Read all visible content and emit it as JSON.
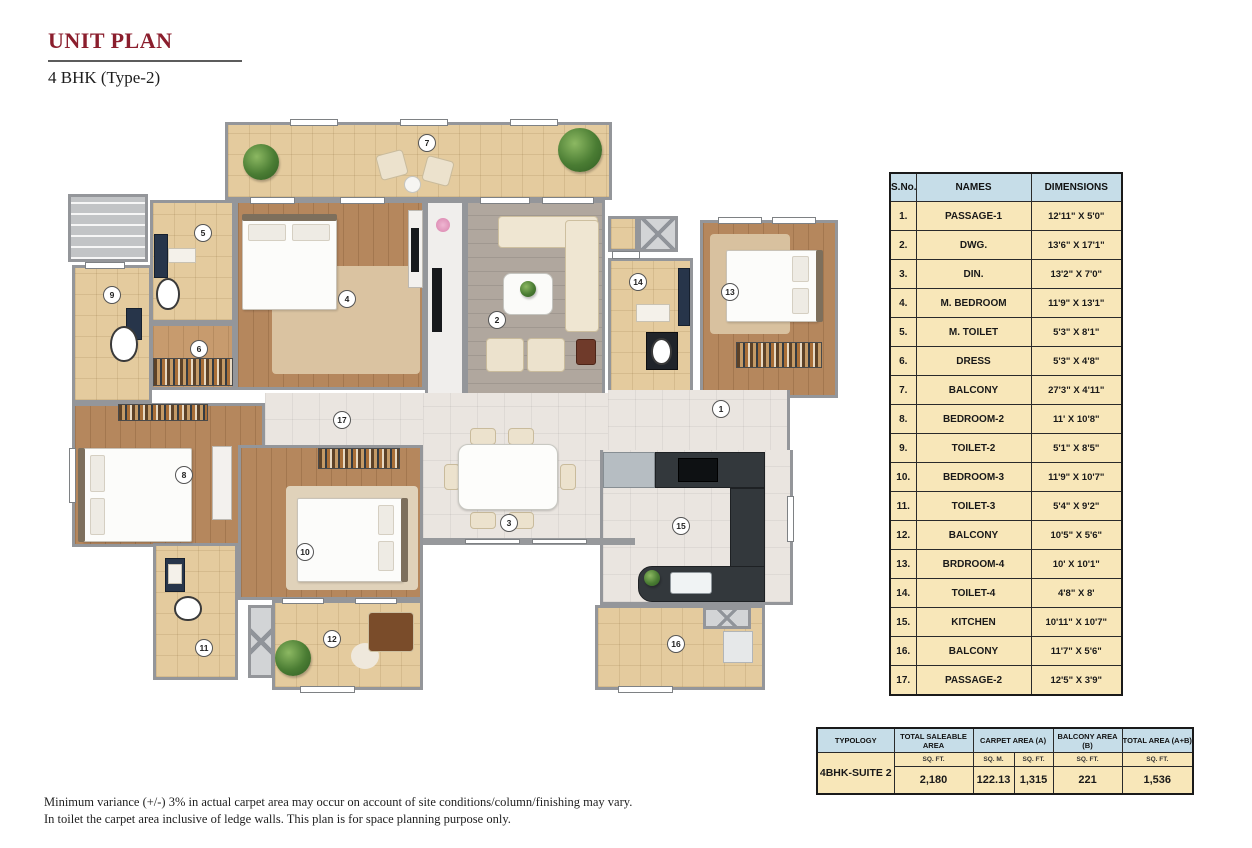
{
  "header": {
    "title": "UNIT PLAN",
    "subtitle": "4 BHK (Type-2)"
  },
  "colors": {
    "accent_maroon": "#8b1e2d",
    "table_header_blue": "#c6dde8",
    "table_body_cream": "#f8e7b9",
    "wall_gray": "#97999c"
  },
  "rooms_table": {
    "headers": [
      "S.No.",
      "NAMES",
      "DIMENSIONS"
    ],
    "rows": [
      {
        "sno": "1.",
        "name": "PASSAGE-1",
        "dim": "12'11\" X 5'0\""
      },
      {
        "sno": "2.",
        "name": "DWG.",
        "dim": "13'6\" X 17'1\""
      },
      {
        "sno": "3.",
        "name": "DIN.",
        "dim": "13'2\" X 7'0\""
      },
      {
        "sno": "4.",
        "name": "M. BEDROOM",
        "dim": "11'9\" X 13'1\""
      },
      {
        "sno": "5.",
        "name": "M. TOILET",
        "dim": "5'3\" X 8'1\""
      },
      {
        "sno": "6.",
        "name": "DRESS",
        "dim": "5'3\" X 4'8\""
      },
      {
        "sno": "7.",
        "name": "BALCONY",
        "dim": "27'3\" X 4'11\""
      },
      {
        "sno": "8.",
        "name": "BEDROOM-2",
        "dim": "11' X 10'8\""
      },
      {
        "sno": "9.",
        "name": "TOILET-2",
        "dim": "5'1\" X 8'5\""
      },
      {
        "sno": "10.",
        "name": "BEDROOM-3",
        "dim": "11'9\" X 10'7\""
      },
      {
        "sno": "11.",
        "name": "TOILET-3",
        "dim": "5'4\" X 9'2\""
      },
      {
        "sno": "12.",
        "name": "BALCONY",
        "dim": "10'5\" X 5'6\""
      },
      {
        "sno": "13.",
        "name": "BRDROOM-4",
        "dim": "10' X 10'1\""
      },
      {
        "sno": "14.",
        "name": "TOILET-4",
        "dim": "4'8\" X 8'"
      },
      {
        "sno": "15.",
        "name": "KITCHEN",
        "dim": "10'11\" X 10'7\""
      },
      {
        "sno": "16.",
        "name": "BALCONY",
        "dim": "11'7\" X 5'6\""
      },
      {
        "sno": "17.",
        "name": "PASSAGE-2",
        "dim": "12'5\" X 3'9\""
      }
    ]
  },
  "area_table": {
    "headers": [
      "TYPOLOGY",
      "TOTAL SALEABLE AREA",
      "CARPET AREA  (A)",
      "BALCONY AREA   (B)",
      "TOTAL AREA  (A+B)"
    ],
    "typology_value": "4BHK-SUITE 2",
    "units": [
      "SQ. FT.",
      "SQ. M.",
      "SQ. FT.",
      "SQ. FT.",
      "SQ. FT."
    ],
    "values": [
      "2,180",
      "122.13",
      "1,315",
      "221",
      "1,536"
    ]
  },
  "footnote": {
    "line1": "Minimum variance (+/-) 3% in actual carpet area may occur on account of site conditions/column/finishing may vary.",
    "line2": "In toilet the carpet area inclusive of ledge walls. This plan is for space planning purpose only."
  },
  "plan": {
    "rooms": [
      {
        "id": "lobby-stairs",
        "fl": "stairs",
        "x": 8,
        "y": 76,
        "w": 80,
        "h": 68,
        "b": "1111"
      },
      {
        "id": "balcony-7",
        "fl": "beige",
        "x": 165,
        "y": 4,
        "w": 387,
        "h": 78,
        "b": "1111"
      },
      {
        "id": "m-toilet-5",
        "fl": "beige",
        "x": 90,
        "y": 82,
        "w": 85,
        "h": 123,
        "b": "1111"
      },
      {
        "id": "toilet-2",
        "fl": "beige",
        "x": 12,
        "y": 147,
        "w": 80,
        "h": 138,
        "b": "1111"
      },
      {
        "id": "m-bedroom-4",
        "fl": "wood",
        "x": 175,
        "y": 82,
        "w": 190,
        "h": 190,
        "b": "1111"
      },
      {
        "id": "tv-niche",
        "fl": "plain",
        "x": 365,
        "y": 82,
        "w": 40,
        "h": 198,
        "b": "1111"
      },
      {
        "id": "dress-6",
        "fl": "woodlight",
        "x": 90,
        "y": 205,
        "w": 85,
        "h": 67,
        "b": "1111"
      },
      {
        "id": "dwg-2",
        "fl": "tilegray",
        "x": 405,
        "y": 82,
        "w": 140,
        "h": 198,
        "b": "1101"
      },
      {
        "id": "shaft-closet",
        "fl": "beige",
        "x": 548,
        "y": 98,
        "w": 30,
        "h": 36,
        "b": "1111"
      },
      {
        "id": "shaft-1",
        "fl": "shaft",
        "x": 578,
        "y": 98,
        "w": 40,
        "h": 36,
        "b": "1111"
      },
      {
        "id": "toilet-4",
        "fl": "beige",
        "x": 548,
        "y": 140,
        "w": 85,
        "h": 140,
        "b": "1111"
      },
      {
        "id": "bedroom-4",
        "fl": "wood",
        "x": 640,
        "y": 102,
        "w": 138,
        "h": 178,
        "b": "1111"
      },
      {
        "id": "passage-2",
        "fl": "tile",
        "x": 205,
        "y": 275,
        "w": 160,
        "h": 54,
        "b": "0000"
      },
      {
        "id": "dining-3",
        "fl": "tile",
        "x": 363,
        "y": 275,
        "w": 205,
        "h": 149,
        "b": "0000"
      },
      {
        "id": "passage-1",
        "fl": "tile",
        "x": 548,
        "y": 272,
        "w": 182,
        "h": 64,
        "b": "0100"
      },
      {
        "id": "bedroom-2",
        "fl": "wood",
        "x": 12,
        "y": 285,
        "w": 193,
        "h": 144,
        "b": "1111"
      },
      {
        "id": "bedroom-3",
        "fl": "wood",
        "x": 178,
        "y": 327,
        "w": 185,
        "h": 155,
        "b": "1111"
      },
      {
        "id": "toilet-3",
        "fl": "beige",
        "x": 93,
        "y": 425,
        "w": 85,
        "h": 137,
        "b": "1111"
      },
      {
        "id": "shaft-3",
        "fl": "shaft",
        "x": 188,
        "y": 487,
        "w": 26,
        "h": 73,
        "b": "1111"
      },
      {
        "id": "balcony-12",
        "fl": "beige",
        "x": 212,
        "y": 482,
        "w": 151,
        "h": 90,
        "b": "1111"
      },
      {
        "id": "kitchen-15",
        "fl": "tile",
        "x": 540,
        "y": 332,
        "w": 193,
        "h": 155,
        "b": "0111"
      },
      {
        "id": "balcony-16",
        "fl": "beige",
        "x": 535,
        "y": 487,
        "w": 170,
        "h": 85,
        "b": "1111"
      },
      {
        "id": "shaft-2",
        "fl": "shaft",
        "x": 643,
        "y": 489,
        "w": 48,
        "h": 22,
        "b": "1111"
      }
    ],
    "walls": [
      {
        "x": 363,
        "y": 420,
        "w": 212,
        "h": 7
      }
    ],
    "windows": [
      {
        "x": 230,
        "y": 1,
        "w": 48,
        "h": 7
      },
      {
        "x": 340,
        "y": 1,
        "w": 48,
        "h": 7
      },
      {
        "x": 450,
        "y": 1,
        "w": 48,
        "h": 7
      },
      {
        "x": 190,
        "y": 79,
        "w": 45,
        "h": 7
      },
      {
        "x": 280,
        "y": 79,
        "w": 45,
        "h": 7
      },
      {
        "x": 420,
        "y": 79,
        "w": 50,
        "h": 7
      },
      {
        "x": 482,
        "y": 79,
        "w": 52,
        "h": 7
      },
      {
        "x": 658,
        "y": 99,
        "w": 44,
        "h": 7
      },
      {
        "x": 712,
        "y": 99,
        "w": 44,
        "h": 7
      },
      {
        "x": 552,
        "y": 133,
        "w": 28,
        "h": 8
      },
      {
        "x": 222,
        "y": 480,
        "w": 42,
        "h": 6
      },
      {
        "x": 295,
        "y": 480,
        "w": 42,
        "h": 6
      },
      {
        "x": 240,
        "y": 568,
        "w": 55,
        "h": 7
      },
      {
        "x": 558,
        "y": 568,
        "w": 55,
        "h": 7
      },
      {
        "x": 9,
        "y": 330,
        "w": 7,
        "h": 55
      },
      {
        "x": 25,
        "y": 144,
        "w": 40,
        "h": 7
      },
      {
        "x": 727,
        "y": 378,
        "w": 7,
        "h": 46
      },
      {
        "x": 405,
        "y": 421,
        "w": 55,
        "h": 5
      },
      {
        "x": 472,
        "y": 421,
        "w": 55,
        "h": 5
      }
    ],
    "furniture": [
      {
        "t": "plant",
        "x": 183,
        "y": 26,
        "w": 36,
        "h": 36
      },
      {
        "t": "plant",
        "x": 498,
        "y": 10,
        "w": 44,
        "h": 44
      },
      {
        "t": "chair",
        "x": 318,
        "y": 34,
        "w": 28,
        "h": 26,
        "r": -15
      },
      {
        "t": "chair",
        "x": 364,
        "y": 40,
        "w": 28,
        "h": 26,
        "r": 15
      },
      {
        "t": "tround",
        "x": 344,
        "y": 58,
        "w": 17,
        "h": 17
      },
      {
        "t": "vanity",
        "x": 94,
        "y": 116,
        "w": 14,
        "h": 44
      },
      {
        "t": "cwhite",
        "x": 108,
        "y": 130,
        "w": 28,
        "h": 15
      },
      {
        "t": "wc",
        "x": 96,
        "y": 160,
        "w": 24,
        "h": 32
      },
      {
        "t": "vanity",
        "x": 66,
        "y": 190,
        "w": 16,
        "h": 32
      },
      {
        "t": "wc",
        "x": 50,
        "y": 208,
        "w": 28,
        "h": 36
      },
      {
        "t": "rug",
        "x": 212,
        "y": 148,
        "w": 148,
        "h": 108,
        "c": "#dac3a1"
      },
      {
        "t": "bed",
        "x": 182,
        "y": 100,
        "w": 95,
        "h": 92
      },
      {
        "t": "hb",
        "x": 182,
        "y": 96,
        "w": 95,
        "h": 7
      },
      {
        "t": "pillow",
        "x": 188,
        "y": 106,
        "w": 38,
        "h": 17
      },
      {
        "t": "pillow",
        "x": 232,
        "y": 106,
        "w": 38,
        "h": 17
      },
      {
        "t": "dresser",
        "x": 348,
        "y": 92,
        "w": 15,
        "h": 78
      },
      {
        "t": "tv",
        "x": 351,
        "y": 110,
        "w": 8,
        "h": 44
      },
      {
        "t": "flower",
        "x": 376,
        "y": 100,
        "w": 14,
        "h": 14
      },
      {
        "t": "tv",
        "x": 372,
        "y": 150,
        "w": 10,
        "h": 64
      },
      {
        "t": "wardrobe",
        "x": 93,
        "y": 240,
        "w": 80,
        "h": 28
      },
      {
        "t": "sofa",
        "x": 438,
        "y": 98,
        "w": 100,
        "h": 32
      },
      {
        "t": "sofa",
        "x": 505,
        "y": 102,
        "w": 34,
        "h": 112
      },
      {
        "t": "ctable",
        "x": 443,
        "y": 155,
        "w": 50,
        "h": 42
      },
      {
        "t": "plant",
        "x": 460,
        "y": 163,
        "w": 16,
        "h": 16
      },
      {
        "t": "chair",
        "x": 426,
        "y": 220,
        "w": 38,
        "h": 34
      },
      {
        "t": "chair",
        "x": 467,
        "y": 220,
        "w": 38,
        "h": 34
      },
      {
        "t": "sidetable",
        "x": 516,
        "y": 221,
        "w": 20,
        "h": 26
      },
      {
        "t": "cwhite",
        "x": 576,
        "y": 186,
        "w": 34,
        "h": 18
      },
      {
        "t": "darkbox",
        "x": 586,
        "y": 214,
        "w": 32,
        "h": 38
      },
      {
        "t": "wc",
        "x": 591,
        "y": 220,
        "w": 21,
        "h": 27
      },
      {
        "t": "vanity",
        "x": 618,
        "y": 150,
        "w": 12,
        "h": 58
      },
      {
        "t": "rug",
        "x": 650,
        "y": 116,
        "w": 80,
        "h": 100,
        "c": "#d8c19f"
      },
      {
        "t": "bed",
        "x": 666,
        "y": 132,
        "w": 92,
        "h": 72
      },
      {
        "t": "hb",
        "x": 756,
        "y": 132,
        "w": 7,
        "h": 72
      },
      {
        "t": "pillow",
        "x": 732,
        "y": 138,
        "w": 17,
        "h": 26
      },
      {
        "t": "pillow",
        "x": 732,
        "y": 170,
        "w": 17,
        "h": 26
      },
      {
        "t": "wardrobe",
        "x": 676,
        "y": 224,
        "w": 86,
        "h": 26
      },
      {
        "t": "chair",
        "x": 410,
        "y": 310,
        "w": 26,
        "h": 17
      },
      {
        "t": "chair",
        "x": 448,
        "y": 310,
        "w": 26,
        "h": 17
      },
      {
        "t": "chair",
        "x": 410,
        "y": 394,
        "w": 26,
        "h": 17
      },
      {
        "t": "chair",
        "x": 448,
        "y": 394,
        "w": 26,
        "h": 17
      },
      {
        "t": "chair",
        "x": 384,
        "y": 346,
        "w": 16,
        "h": 26
      },
      {
        "t": "chair",
        "x": 500,
        "y": 346,
        "w": 16,
        "h": 26
      },
      {
        "t": "dtable",
        "x": 398,
        "y": 326,
        "w": 100,
        "h": 66
      },
      {
        "t": "wardrobe",
        "x": 58,
        "y": 286,
        "w": 90,
        "h": 17
      },
      {
        "t": "bed",
        "x": 22,
        "y": 330,
        "w": 110,
        "h": 94
      },
      {
        "t": "hb",
        "x": 18,
        "y": 330,
        "w": 7,
        "h": 94
      },
      {
        "t": "pillow",
        "x": 30,
        "y": 337,
        "w": 15,
        "h": 37
      },
      {
        "t": "pillow",
        "x": 30,
        "y": 380,
        "w": 15,
        "h": 37
      },
      {
        "t": "dresser",
        "x": 152,
        "y": 328,
        "w": 20,
        "h": 74
      },
      {
        "t": "wardrobe",
        "x": 258,
        "y": 330,
        "w": 82,
        "h": 21
      },
      {
        "t": "rug",
        "x": 226,
        "y": 368,
        "w": 132,
        "h": 104,
        "c": "#e0d2ba"
      },
      {
        "t": "bed",
        "x": 237,
        "y": 380,
        "w": 106,
        "h": 84
      },
      {
        "t": "hb",
        "x": 341,
        "y": 380,
        "w": 7,
        "h": 84
      },
      {
        "t": "pillow",
        "x": 318,
        "y": 387,
        "w": 16,
        "h": 30
      },
      {
        "t": "pillow",
        "x": 318,
        "y": 423,
        "w": 16,
        "h": 30
      },
      {
        "t": "vanity",
        "x": 105,
        "y": 440,
        "w": 20,
        "h": 34
      },
      {
        "t": "cwhite",
        "x": 108,
        "y": 446,
        "w": 14,
        "h": 20
      },
      {
        "t": "wc",
        "x": 114,
        "y": 478,
        "w": 28,
        "h": 25
      },
      {
        "t": "rug",
        "x": 291,
        "y": 525,
        "w": 28,
        "h": 26,
        "c": "#efe8dc",
        "br": "50%"
      },
      {
        "t": "plant",
        "x": 215,
        "y": 522,
        "w": 36,
        "h": 36
      },
      {
        "t": "sofa",
        "x": 308,
        "y": 494,
        "w": 46,
        "h": 40,
        "c": "#7a4c2a"
      },
      {
        "t": "fridge",
        "x": 543,
        "y": 334,
        "w": 52,
        "h": 36
      },
      {
        "t": "counter",
        "x": 595,
        "y": 334,
        "w": 110,
        "h": 36
      },
      {
        "t": "hob",
        "x": 618,
        "y": 340,
        "w": 40,
        "h": 24
      },
      {
        "t": "counter",
        "x": 670,
        "y": 370,
        "w": 35,
        "h": 84
      },
      {
        "t": "counter",
        "x": 578,
        "y": 448,
        "w": 127,
        "h": 36,
        "br": "14px 0 0 14px"
      },
      {
        "t": "sink",
        "x": 610,
        "y": 454,
        "w": 42,
        "h": 22
      },
      {
        "t": "plant",
        "x": 584,
        "y": 452,
        "w": 16,
        "h": 16
      },
      {
        "t": "box",
        "x": 663,
        "y": 513,
        "w": 30,
        "h": 32
      }
    ],
    "markers": [
      {
        "n": "1",
        "x": 652,
        "y": 282
      },
      {
        "n": "2",
        "x": 428,
        "y": 193
      },
      {
        "n": "3",
        "x": 440,
        "y": 396
      },
      {
        "n": "4",
        "x": 278,
        "y": 172
      },
      {
        "n": "5",
        "x": 134,
        "y": 106
      },
      {
        "n": "6",
        "x": 130,
        "y": 222
      },
      {
        "n": "7",
        "x": 358,
        "y": 16
      },
      {
        "n": "8",
        "x": 115,
        "y": 348
      },
      {
        "n": "9",
        "x": 43,
        "y": 168
      },
      {
        "n": "10",
        "x": 236,
        "y": 425
      },
      {
        "n": "11",
        "x": 135,
        "y": 521
      },
      {
        "n": "12",
        "x": 263,
        "y": 512
      },
      {
        "n": "13",
        "x": 661,
        "y": 165
      },
      {
        "n": "14",
        "x": 569,
        "y": 155
      },
      {
        "n": "15",
        "x": 612,
        "y": 399
      },
      {
        "n": "16",
        "x": 607,
        "y": 517
      },
      {
        "n": "17",
        "x": 273,
        "y": 293
      }
    ]
  }
}
